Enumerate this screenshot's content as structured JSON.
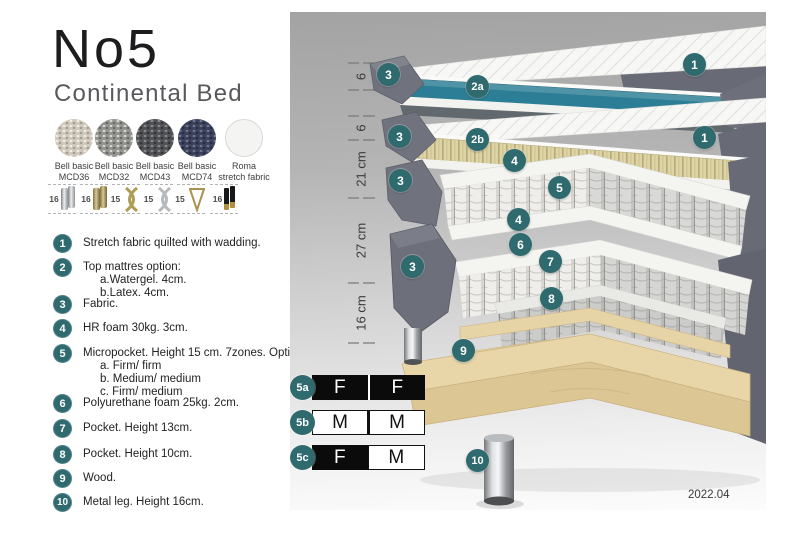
{
  "header": {
    "title": "No5",
    "subtitle": "Continental Bed"
  },
  "fabrics": [
    {
      "line1": "Bell basic",
      "line2": "MCD36"
    },
    {
      "line1": "Bell basic",
      "line2": "MCD32"
    },
    {
      "line1": "Bell basic",
      "line2": "MCD43"
    },
    {
      "line1": "Bell basic",
      "line2": "MCD74"
    },
    {
      "line1": "Roma",
      "line2": "stretch fabric"
    }
  ],
  "legs": [
    {
      "height": "16",
      "type": "cylinder-silver"
    },
    {
      "height": "16",
      "type": "cylinder-gold"
    },
    {
      "height": "15",
      "type": "twist-gold"
    },
    {
      "height": "15",
      "type": "twist-silver"
    },
    {
      "height": "15",
      "type": "hairpin-gold"
    },
    {
      "height": "16",
      "type": "taper-black-gold"
    }
  ],
  "spec_list": {
    "items": [
      {
        "num": "1",
        "text": "Stretch fabric quilted with wadding."
      },
      {
        "num": "2",
        "text": "Top mattres option:",
        "subs": [
          "a.Watergel. 4cm.",
          "b.Latex. 4cm."
        ]
      },
      {
        "num": "3",
        "text": "Fabric."
      },
      {
        "num": "4",
        "text": "HR foam 30kg. 3cm."
      },
      {
        "num": "5",
        "text": "Micropocket. Height 15 cm. 7zones. Option:",
        "subs": [
          "a. Firm/ firm",
          "b. Medium/ medium",
          "c. Firm/ medium"
        ]
      },
      {
        "num": "6",
        "text": "Polyurethane foam 25kg. 2cm."
      },
      {
        "num": "7",
        "text": "Pocket. Height 13cm."
      },
      {
        "num": "8",
        "text": "Pocket. Height 10cm."
      },
      {
        "num": "9",
        "text": "Wood."
      },
      {
        "num": "10",
        "text": "Metal leg. Height 16cm."
      }
    ]
  },
  "diagram": {
    "dimensions": [
      {
        "label": "6"
      },
      {
        "label": "6"
      },
      {
        "label": "21 cm"
      },
      {
        "label": "27 cm"
      },
      {
        "label": "16 cm"
      }
    ],
    "callouts": [
      {
        "id": "layer1-top",
        "label": "1"
      },
      {
        "id": "layer1-fabric",
        "label": "3"
      },
      {
        "id": "watergel-core",
        "label": "2a"
      },
      {
        "id": "layer2-top",
        "label": "1"
      },
      {
        "id": "layer2-fabric",
        "label": "3"
      },
      {
        "id": "latex-core",
        "label": "2b"
      },
      {
        "id": "hr-foam-top",
        "label": "4"
      },
      {
        "id": "micropocket-springs",
        "label": "5"
      },
      {
        "id": "hr-foam-bottom",
        "label": "4"
      },
      {
        "id": "layer3-fabric",
        "label": "3"
      },
      {
        "id": "polyurethane-foam",
        "label": "6"
      },
      {
        "id": "pocket-13",
        "label": "7"
      },
      {
        "id": "layer4-fabric",
        "label": "3"
      },
      {
        "id": "pocket-10",
        "label": "8"
      },
      {
        "id": "wood-frame",
        "label": "9"
      },
      {
        "id": "metal-leg",
        "label": "10"
      }
    ],
    "colors": {
      "badge_teal": "#2F6A6E",
      "core_teal": "#2B7E95",
      "latex_tan": "#DDD3A4",
      "fabric_gray": "#6D707B",
      "wood": "#E3D0A4"
    }
  },
  "firmness_table": {
    "rows": [
      {
        "label": "5a",
        "cells": [
          {
            "value": "F",
            "variant": "dark"
          },
          {
            "value": "F",
            "variant": "dark"
          }
        ]
      },
      {
        "label": "5b",
        "cells": [
          {
            "value": "M",
            "variant": "light"
          },
          {
            "value": "M",
            "variant": "light"
          }
        ]
      },
      {
        "label": "5c",
        "cells": [
          {
            "value": "F",
            "variant": "dark"
          },
          {
            "value": "M",
            "variant": "light"
          }
        ]
      }
    ]
  },
  "footer": {
    "version": "2022.04"
  }
}
